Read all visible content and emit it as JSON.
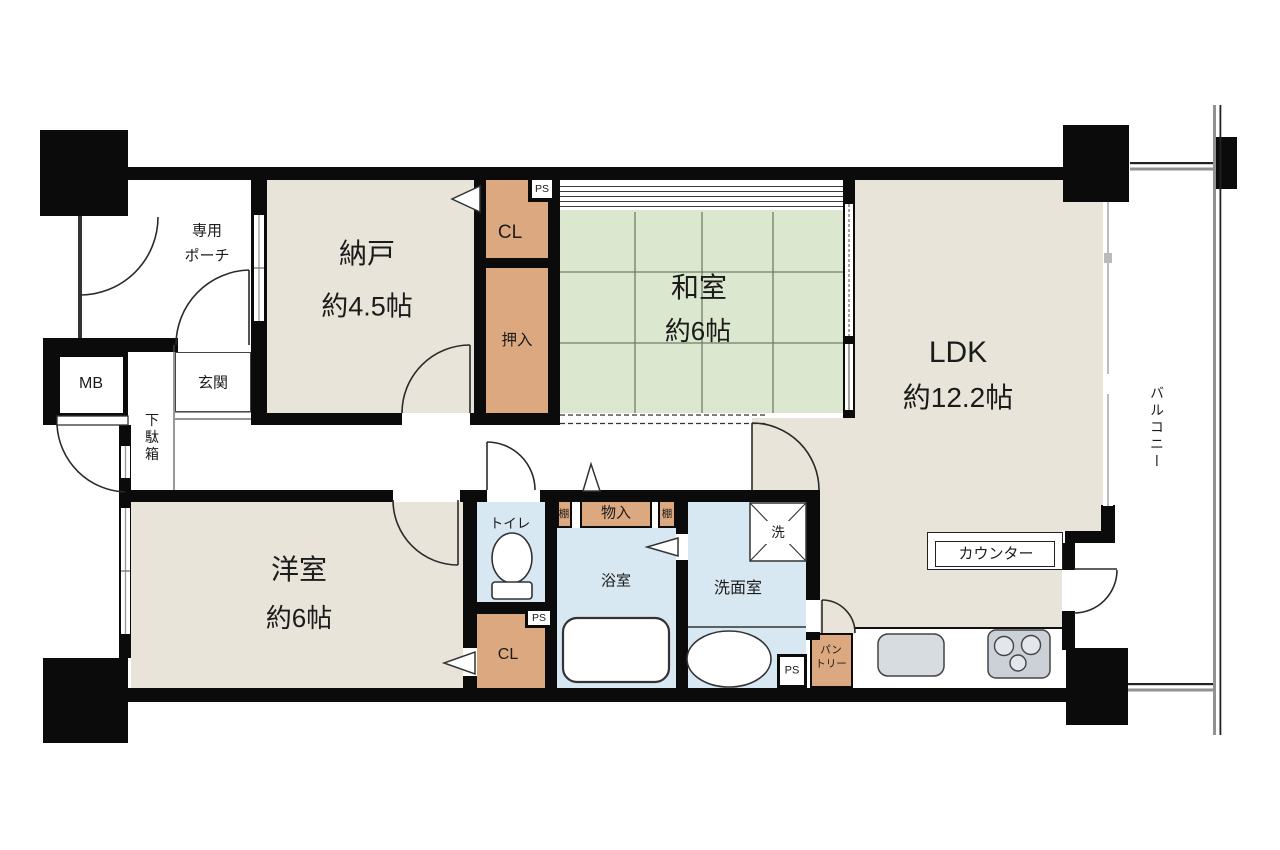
{
  "title": "間取り図 (floor plan)",
  "colors": {
    "room_beige": "#E8E4DA",
    "tatami_green": "#DBE7CE",
    "closet_tan": "#DCA87F",
    "wet_blue": "#D8E8F2",
    "wall_black": "#0B0B0B",
    "fixture_gray": "#D7DCE1",
    "stove_gray": "#CBD1D7",
    "railing_gray": "#919191"
  },
  "rooms": {
    "nando": {
      "name": "納戸",
      "size": "約4.5帖"
    },
    "washitsu": {
      "name": "和室",
      "size": "約6帖"
    },
    "ldk": {
      "name": "LDK",
      "size": "約12.2帖"
    },
    "yoshitsu": {
      "name": "洋室",
      "size": "約6帖"
    },
    "porch": {
      "line1": "専用",
      "line2": "ポーチ"
    },
    "genkan": {
      "name": "玄関"
    },
    "getabako": {
      "name": "下駄箱"
    },
    "mb": {
      "name": "MB"
    },
    "cl_top": {
      "name": "CL"
    },
    "oshiire": {
      "name": "押入"
    },
    "toilet": {
      "name": "トイレ"
    },
    "monoire": {
      "name": "物入"
    },
    "tana": {
      "name": "棚"
    },
    "bath": {
      "name": "浴室"
    },
    "senmenshitsu": {
      "name": "洗面室"
    },
    "washer": {
      "name": "洗"
    },
    "cl_bottom": {
      "name": "CL"
    },
    "pantry": {
      "line1": "パン",
      "line2": "トリー"
    },
    "counter": {
      "name": "カウンター"
    },
    "balcony": {
      "name": "バルコニー"
    },
    "ps": {
      "name": "PS"
    }
  }
}
